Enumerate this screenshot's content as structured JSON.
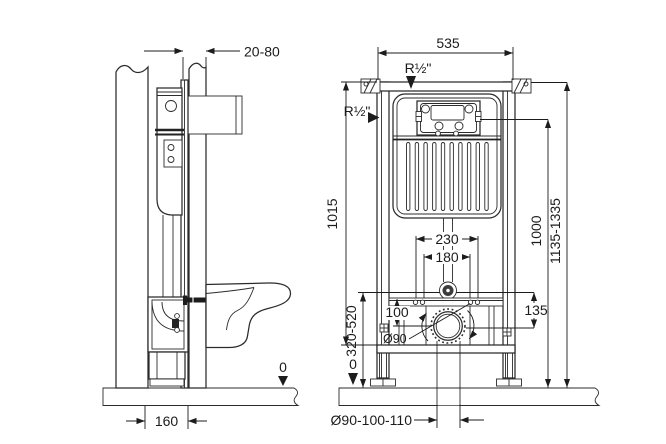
{
  "drawing": {
    "title": "wall-hung-wc-concealed-cistern-installation-drawing",
    "views": {
      "left": "side-section-view",
      "right": "front-elevation-view"
    }
  },
  "dimensions": {
    "wall_clearance": "20-80",
    "frame_width": "535",
    "water_inlet_top": "R½\"",
    "water_inlet_side": "R½\"",
    "frame_height": "1015",
    "flush_plate_height": "1000",
    "overall_height": "1135-1335",
    "fixing_bolts_outer": "230",
    "fixing_bolts_inner": "180",
    "inlet_to_outlet": "135",
    "rail_to_outlet": "100",
    "outlet_height_range": "320-520",
    "outlet_diameter": "Ø90",
    "drain_pipe_sizes": "Ø90-100-110",
    "frame_depth": "160",
    "floor_level_side": "0",
    "floor_level_front": "0"
  }
}
